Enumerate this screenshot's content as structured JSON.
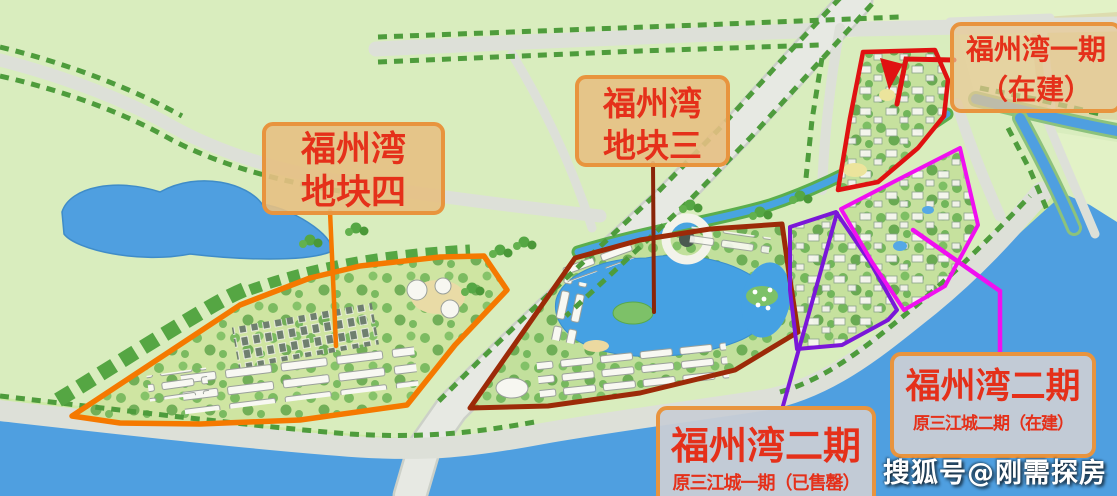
{
  "labels": {
    "plot4": {
      "line1": "福州湾",
      "line2": "地块四"
    },
    "plot3": {
      "line1": "福州湾",
      "line2": "地块三"
    },
    "phase1": {
      "line1": "福州湾一期",
      "line2": "（在建）"
    },
    "phase2_sold_out": {
      "title": "福州湾二期",
      "subtitle": "原三江城一期（已售罄）"
    },
    "phase2_in_construction": {
      "title": "福州湾二期",
      "subtitle": "原三江城二期（在建）"
    }
  },
  "watermark": {
    "text": "搜狐号@刚需探房"
  },
  "colors": {
    "plot4_outline": "#f57900",
    "plot3_outline": "#9c2a08",
    "phase1_outline": "#e01111",
    "phase2_sold_outline": "#7a17d8",
    "phase2_construction_outline": "#f010f0",
    "label_border": "#e8943e",
    "label_text": "#e5301a",
    "label_fill_tan": "#e5c083",
    "label_fill_grey": "#c8cdd5",
    "water": "#4f9fe0",
    "field": "#d9edbe",
    "road": "#dde0d8",
    "tree": "#4e9c3c"
  }
}
